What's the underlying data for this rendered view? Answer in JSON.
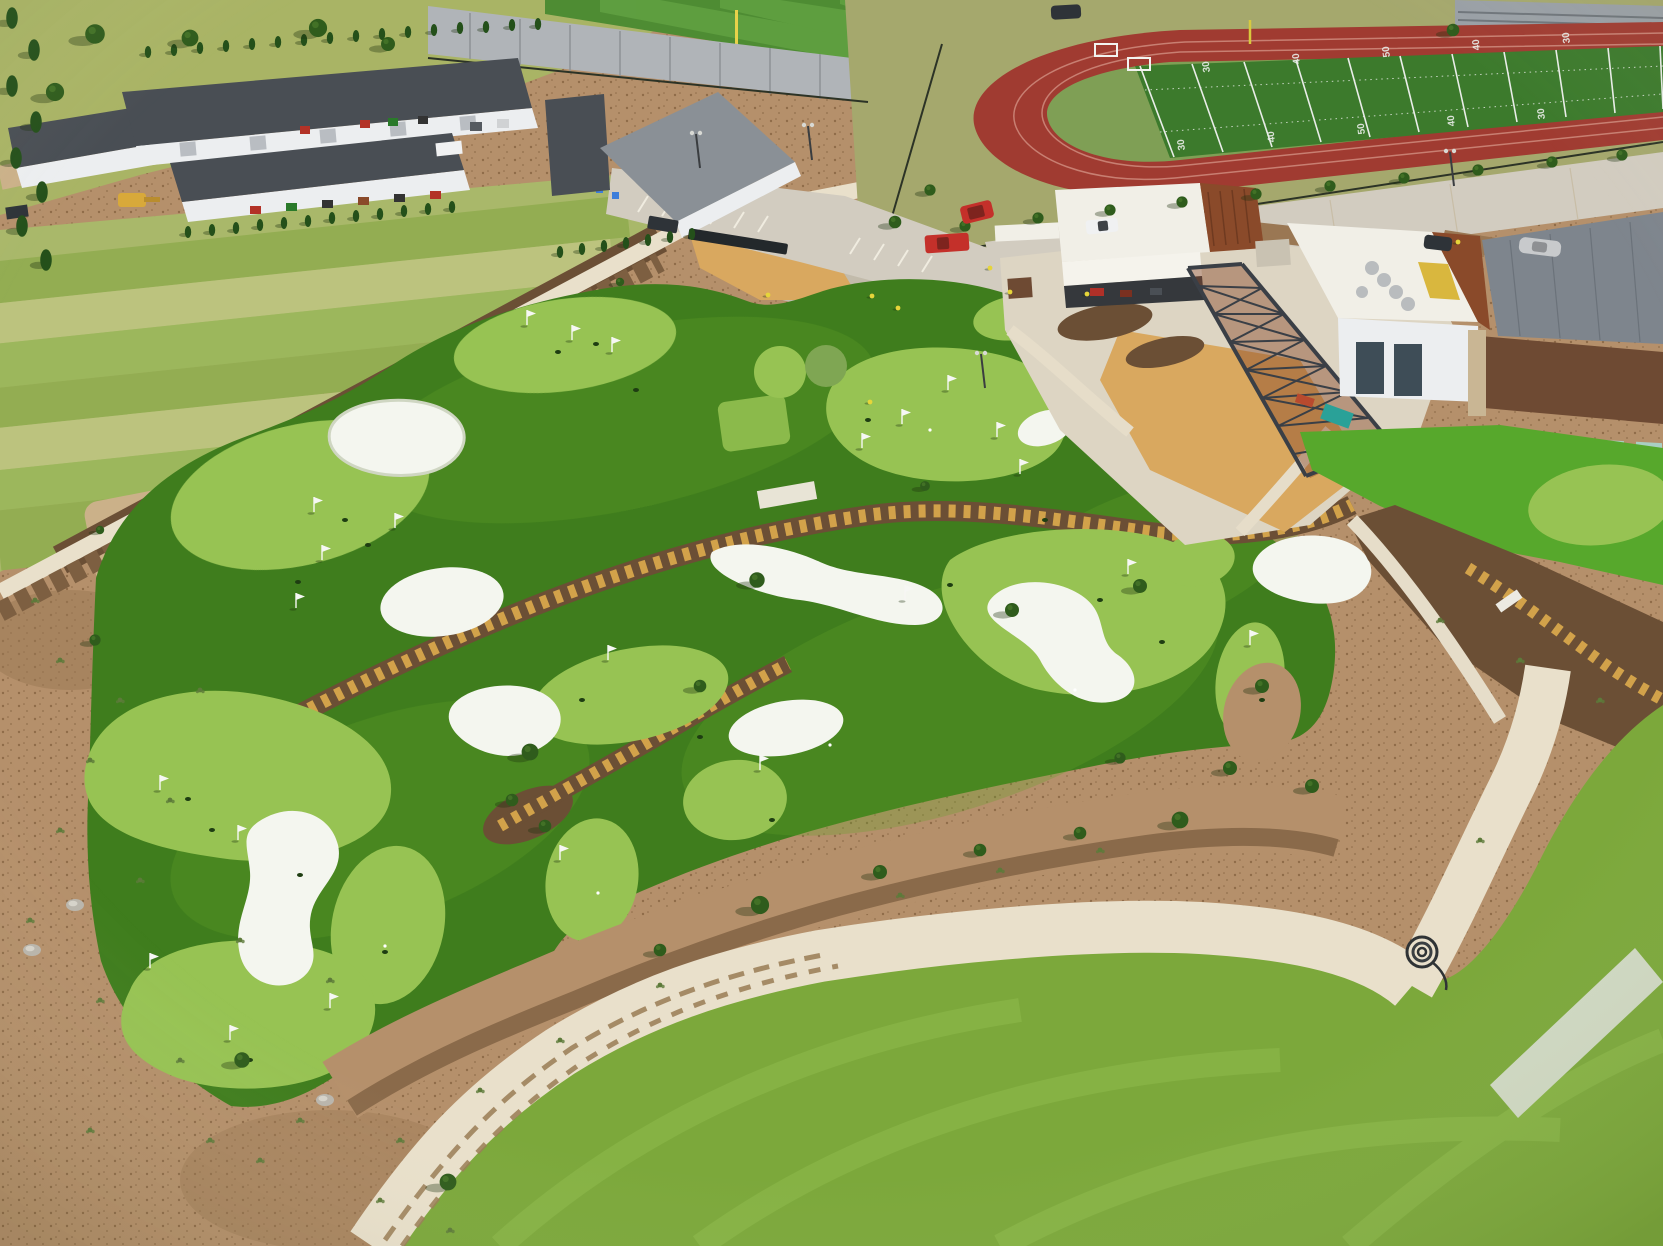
{
  "meta": {
    "description": "Aerial drone photograph of a newly built golf entertainment campus: a large artificial-turf putting course with white sand bunkers and flags, clubhouse with corten steel observation tower, maintenance warehouses, sod farm, baseball field, running track with football field, parking lots and walking paths.",
    "time_of_day": "midday, sunny",
    "view": "oblique aerial"
  },
  "palette": {
    "dirt": "#b5906b",
    "dirt_speckle": "#8f6c49",
    "dirt_dark": "#9a7753",
    "mulch": "#6b4f35",
    "rubble": "#7d5f41",
    "gravel_border": "#8a6a4a",
    "course_turf": "#3f7d1d",
    "course_turf_light": "#55941f",
    "course_streak": "#62a228",
    "putting_green": "#97c353",
    "putting_green_light": "#a8d163",
    "putting_olive": "#7fa653",
    "bunker": "#f4f6ef",
    "bunker_shadow": "#cfd6c2",
    "lawn": "#7ca83b",
    "lawn_streak": "#90bc4e",
    "path": "#e9e0cb",
    "path_joint": "#c8bda6",
    "path_dirt": "#9a7d55",
    "road": "#d2ccc0",
    "plaza": "#ddd5c3",
    "sidewalk": "#e6ddc9",
    "sod_a": "#a9b86a",
    "sod_b": "#93ad52",
    "sod_c": "#bcc37e",
    "sod_d": "#9cb75c",
    "field_grass": "#a5a86d",
    "topleft_grass": "#a9b465",
    "sand": "#d9a85f",
    "sand_pit": "#cbb189",
    "gravel_yard": "#c2bbab",
    "roof_dark": "#494e54",
    "roof_gray": "#8a9096",
    "wall_white": "#eceef0",
    "door_gray": "#b9bdc2",
    "clubhouse_roof": "#f1efe7",
    "corten": "#8a4a2a",
    "steel": "#3a3f46",
    "awning": "#f5f3ec",
    "patio_shadow": "#35383c",
    "bldg2_roof": "#7e858d",
    "brown_band": "#6e4a33",
    "window_glass": "#a9cfc2",
    "glass_dark": "#3e4d57",
    "stone": "#c9b694",
    "turf_apron": "#57a82c",
    "track": "#a03b31",
    "track_line": "#c87f72",
    "field_turf": "#3c7a2c",
    "dzone": "#7f9f55",
    "field_line": "#e9ede8",
    "ball_grass_a": "#4e8c33",
    "ball_grass_b": "#60a041",
    "infield_dirt": "#c29a62",
    "wall_gray": "#b0b4b8",
    "bleacher": "#9aa0a6",
    "fence": "#2c3326",
    "tree": "#2f5c1c",
    "tree_light": "#4a7a2b",
    "cypress": "#24501a",
    "shrub": "#5d7a3a",
    "tuft_gold": "#d2a24a",
    "flag_white": "#f6f7f4",
    "hole": "#1e3d12",
    "car_red": "#c4302a",
    "car_silver": "#c8cacc",
    "car_dark": "#2e3338",
    "car_white": "#f0f1f2",
    "excavator": "#d8a93a",
    "tarp_teal": "#2aa198",
    "hvac": "#b9bcbe",
    "safety_stripe": "#d9b73e",
    "foul_pole": "#e8d24a",
    "pale_strip": "#cfd8c2",
    "shadow": "rgba(30,50,15,0.35)",
    "wall_block": "#e8e4d6"
  },
  "scene": {
    "regions": [
      {
        "label": "maintenance warehouses with equipment yard",
        "position": "top-left"
      },
      {
        "label": "sod farm with turf strips and sand pit",
        "position": "left"
      },
      {
        "label": "baseball field behind gray outfield wall",
        "position": "top-center"
      },
      {
        "label": "running track with football field and bleachers",
        "position": "top-right"
      },
      {
        "label": "parking lot with truck and trailer",
        "position": "top-center"
      },
      {
        "label": "clubhouse with awning and corten observation tower",
        "position": "center-right"
      },
      {
        "label": "modern building with rooftop HVAC and glass doors",
        "position": "right"
      },
      {
        "label": "artificial putting course with bunkers, flags and creek beds",
        "position": "center"
      },
      {
        "label": "bare dirt landscape with young shrubs",
        "position": "bottom-left"
      },
      {
        "label": "natural grass lawn with curved concrete path",
        "position": "bottom-right"
      }
    ],
    "counts": {
      "putting_greens": 15,
      "bunkers": 9,
      "flags": 24,
      "vehicles": 10,
      "creek_beds": 3
    },
    "vehicles": [
      {
        "name": "red-suv",
        "color_key": "car_red"
      },
      {
        "name": "red-pickup",
        "color_key": "car_red"
      },
      {
        "name": "silver-car",
        "color_key": "car_silver"
      },
      {
        "name": "dark-car",
        "color_key": "car_dark"
      },
      {
        "name": "white-truck",
        "color_key": "car_white"
      },
      {
        "name": "pickup-with-trailer",
        "color_key": "car_dark"
      },
      {
        "name": "white-van",
        "color_key": "car_white"
      },
      {
        "name": "excavator",
        "color_key": "excavator"
      },
      {
        "name": "utility-cart",
        "color_key": "car_dark"
      },
      {
        "name": "dark-car-top",
        "color_key": "car_dark"
      }
    ],
    "football_field": {
      "surface": "green turf with white yard lines",
      "yard_numbers_far": [
        "30",
        "40",
        "50",
        "40",
        "30"
      ],
      "yard_numbers_near": [
        "30",
        "40",
        "50",
        "40",
        "30"
      ]
    }
  },
  "repeats": {
    "flags": [
      {
        "x": 527,
        "y": 325
      },
      {
        "x": 572,
        "y": 340
      },
      {
        "x": 612,
        "y": 352
      },
      {
        "x": 862,
        "y": 448
      },
      {
        "x": 902,
        "y": 424
      },
      {
        "x": 948,
        "y": 390
      },
      {
        "x": 997,
        "y": 437
      },
      {
        "x": 1020,
        "y": 474
      },
      {
        "x": 314,
        "y": 512
      },
      {
        "x": 395,
        "y": 528
      },
      {
        "x": 322,
        "y": 560
      },
      {
        "x": 296,
        "y": 608
      },
      {
        "x": 160,
        "y": 790
      },
      {
        "x": 238,
        "y": 840
      },
      {
        "x": 150,
        "y": 968
      },
      {
        "x": 230,
        "y": 1040
      },
      {
        "x": 330,
        "y": 1008
      },
      {
        "x": 608,
        "y": 660
      },
      {
        "x": 560,
        "y": 860
      },
      {
        "x": 760,
        "y": 770
      },
      {
        "x": 1128,
        "y": 574
      },
      {
        "x": 1250,
        "y": 645
      },
      {
        "x": 905,
        "y": 600
      },
      {
        "x": 1650,
        "y": 470
      }
    ],
    "holes": [
      {
        "x": 558,
        "y": 352
      },
      {
        "x": 596,
        "y": 344
      },
      {
        "x": 636,
        "y": 390
      },
      {
        "x": 345,
        "y": 520
      },
      {
        "x": 368,
        "y": 545
      },
      {
        "x": 298,
        "y": 582
      },
      {
        "x": 212,
        "y": 830
      },
      {
        "x": 582,
        "y": 700
      },
      {
        "x": 772,
        "y": 820
      },
      {
        "x": 1100,
        "y": 600
      },
      {
        "x": 1162,
        "y": 642
      },
      {
        "x": 700,
        "y": 737
      },
      {
        "x": 950,
        "y": 585
      },
      {
        "x": 868,
        "y": 420
      },
      {
        "x": 1045,
        "y": 520
      },
      {
        "x": 250,
        "y": 1060
      },
      {
        "x": 1262,
        "y": 700
      },
      {
        "x": 300,
        "y": 875
      },
      {
        "x": 188,
        "y": 799
      },
      {
        "x": 385,
        "y": 952
      }
    ],
    "balls": [
      {
        "x": 1140,
        "y": 470
      },
      {
        "x": 598,
        "y": 893
      },
      {
        "x": 830,
        "y": 745
      },
      {
        "x": 1075,
        "y": 690
      },
      {
        "x": 930,
        "y": 430
      },
      {
        "x": 385,
        "y": 946
      }
    ],
    "trees": [
      {
        "x": 965,
        "y": 226,
        "s": 0.8
      },
      {
        "x": 1038,
        "y": 218,
        "s": 0.8
      },
      {
        "x": 1110,
        "y": 210,
        "s": 0.8
      },
      {
        "x": 1182,
        "y": 202,
        "s": 0.8
      },
      {
        "x": 1256,
        "y": 194,
        "s": 0.8
      },
      {
        "x": 1330,
        "y": 186,
        "s": 0.8
      },
      {
        "x": 1404,
        "y": 178,
        "s": 0.8
      },
      {
        "x": 1478,
        "y": 170,
        "s": 0.8
      },
      {
        "x": 1552,
        "y": 162,
        "s": 0.8
      },
      {
        "x": 1622,
        "y": 155,
        "s": 0.8
      },
      {
        "x": 757,
        "y": 580,
        "s": 1.1
      },
      {
        "x": 1012,
        "y": 610,
        "s": 1
      },
      {
        "x": 1140,
        "y": 586,
        "s": 1
      },
      {
        "x": 925,
        "y": 486,
        "s": 0.7
      },
      {
        "x": 700,
        "y": 686,
        "s": 0.9
      },
      {
        "x": 530,
        "y": 752,
        "s": 1.2
      },
      {
        "x": 512,
        "y": 800,
        "s": 0.9
      },
      {
        "x": 545,
        "y": 826,
        "s": 0.9
      },
      {
        "x": 660,
        "y": 950,
        "s": 0.9
      },
      {
        "x": 760,
        "y": 905,
        "s": 1.3
      },
      {
        "x": 880,
        "y": 872,
        "s": 1
      },
      {
        "x": 980,
        "y": 850,
        "s": 0.9
      },
      {
        "x": 1080,
        "y": 833,
        "s": 0.9
      },
      {
        "x": 1180,
        "y": 820,
        "s": 1.2
      },
      {
        "x": 1262,
        "y": 686,
        "s": 1
      },
      {
        "x": 242,
        "y": 1060,
        "s": 1.1
      },
      {
        "x": 448,
        "y": 1182,
        "s": 1.2
      },
      {
        "x": 95,
        "y": 640,
        "s": 0.8
      },
      {
        "x": 1230,
        "y": 768,
        "s": 1
      },
      {
        "x": 1312,
        "y": 786,
        "s": 1
      },
      {
        "x": 1120,
        "y": 758,
        "s": 0.8
      },
      {
        "x": 95,
        "y": 34,
        "s": 1.4
      },
      {
        "x": 190,
        "y": 38,
        "s": 1.2
      },
      {
        "x": 318,
        "y": 28,
        "s": 1.3
      },
      {
        "x": 388,
        "y": 44,
        "s": 1
      },
      {
        "x": 55,
        "y": 92,
        "s": 1.3
      },
      {
        "x": 895,
        "y": 222,
        "s": 0.9
      },
      {
        "x": 930,
        "y": 190,
        "s": 0.8
      },
      {
        "x": 1453,
        "y": 30,
        "s": 0.9
      }
    ],
    "cypresses": [
      {
        "x": 148,
        "y": 52
      },
      {
        "x": 174,
        "y": 50
      },
      {
        "x": 200,
        "y": 48
      },
      {
        "x": 226,
        "y": 46
      },
      {
        "x": 252,
        "y": 44
      },
      {
        "x": 278,
        "y": 42
      },
      {
        "x": 304,
        "y": 40
      },
      {
        "x": 330,
        "y": 38
      },
      {
        "x": 356,
        "y": 36
      },
      {
        "x": 382,
        "y": 34
      },
      {
        "x": 408,
        "y": 32
      },
      {
        "x": 434,
        "y": 30
      },
      {
        "x": 460,
        "y": 28
      },
      {
        "x": 486,
        "y": 27
      },
      {
        "x": 512,
        "y": 25
      },
      {
        "x": 538,
        "y": 24
      },
      {
        "x": 188,
        "y": 232
      },
      {
        "x": 212,
        "y": 230
      },
      {
        "x": 236,
        "y": 228
      },
      {
        "x": 260,
        "y": 225
      },
      {
        "x": 284,
        "y": 223
      },
      {
        "x": 308,
        "y": 221
      },
      {
        "x": 332,
        "y": 218
      },
      {
        "x": 356,
        "y": 216
      },
      {
        "x": 380,
        "y": 214
      },
      {
        "x": 404,
        "y": 211
      },
      {
        "x": 428,
        "y": 209
      },
      {
        "x": 452,
        "y": 207
      },
      {
        "x": 560,
        "y": 252
      },
      {
        "x": 582,
        "y": 249
      },
      {
        "x": 604,
        "y": 246
      },
      {
        "x": 626,
        "y": 243
      },
      {
        "x": 648,
        "y": 240
      },
      {
        "x": 670,
        "y": 237
      },
      {
        "x": 692,
        "y": 234
      },
      {
        "x": 12,
        "y": 18,
        "s": 1.8
      },
      {
        "x": 34,
        "y": 50,
        "s": 1.8
      },
      {
        "x": 12,
        "y": 86,
        "s": 1.8
      },
      {
        "x": 36,
        "y": 122,
        "s": 1.8
      },
      {
        "x": 16,
        "y": 158,
        "s": 1.8
      },
      {
        "x": 42,
        "y": 192,
        "s": 1.8
      },
      {
        "x": 22,
        "y": 226,
        "s": 1.8
      },
      {
        "x": 46,
        "y": 260,
        "s": 1.8
      }
    ],
    "mulch_trees": [
      {
        "x": 100,
        "y": 530,
        "s": 0.6
      },
      {
        "x": 175,
        "y": 492,
        "s": 0.6
      },
      {
        "x": 250,
        "y": 452,
        "s": 0.6
      },
      {
        "x": 325,
        "y": 415,
        "s": 0.6
      },
      {
        "x": 400,
        "y": 380,
        "s": 0.6
      },
      {
        "x": 475,
        "y": 345,
        "s": 0.6
      },
      {
        "x": 550,
        "y": 312,
        "s": 0.6
      },
      {
        "x": 620,
        "y": 282,
        "s": 0.6
      }
    ],
    "shrubs": [
      {
        "x": 60,
        "y": 660
      },
      {
        "x": 120,
        "y": 700
      },
      {
        "x": 200,
        "y": 690
      },
      {
        "x": 90,
        "y": 760
      },
      {
        "x": 170,
        "y": 800
      },
      {
        "x": 60,
        "y": 830
      },
      {
        "x": 140,
        "y": 880
      },
      {
        "x": 240,
        "y": 940
      },
      {
        "x": 100,
        "y": 1000
      },
      {
        "x": 180,
        "y": 1060
      },
      {
        "x": 300,
        "y": 1120
      },
      {
        "x": 90,
        "y": 1130
      },
      {
        "x": 380,
        "y": 1200
      },
      {
        "x": 35,
        "y": 600
      },
      {
        "x": 260,
        "y": 1160
      },
      {
        "x": 450,
        "y": 1230
      },
      {
        "x": 30,
        "y": 920
      },
      {
        "x": 210,
        "y": 1140
      },
      {
        "x": 400,
        "y": 1140
      },
      {
        "x": 330,
        "y": 980
      },
      {
        "x": 480,
        "y": 1090
      },
      {
        "x": 560,
        "y": 1040
      },
      {
        "x": 660,
        "y": 985
      },
      {
        "x": 900,
        "y": 895
      },
      {
        "x": 1000,
        "y": 870
      },
      {
        "x": 1100,
        "y": 850
      },
      {
        "x": 1440,
        "y": 620
      },
      {
        "x": 1520,
        "y": 660
      },
      {
        "x": 1600,
        "y": 700
      },
      {
        "x": 1480,
        "y": 840
      }
    ],
    "people": [
      {
        "x": 990,
        "y": 268
      },
      {
        "x": 1087,
        "y": 294
      },
      {
        "x": 872,
        "y": 296
      },
      {
        "x": 898,
        "y": 308
      },
      {
        "x": 870,
        "y": 402
      },
      {
        "x": 1458,
        "y": 242
      },
      {
        "x": 768,
        "y": 295
      },
      {
        "x": 1010,
        "y": 292
      }
    ],
    "poles": [
      {
        "x": 700,
        "y": 168
      },
      {
        "x": 812,
        "y": 160
      },
      {
        "x": 985,
        "y": 388
      },
      {
        "x": 1454,
        "y": 186
      }
    ],
    "rocks": [
      {
        "x": 32,
        "y": 950
      },
      {
        "x": 75,
        "y": 905
      },
      {
        "x": 325,
        "y": 1100
      }
    ],
    "yard_numbers_far": [
      {
        "x": 1210,
        "y": 72,
        "r": -97,
        "label": "30"
      },
      {
        "x": 1300,
        "y": 64,
        "r": -97,
        "label": "40"
      },
      {
        "x": 1390,
        "y": 57,
        "r": -97,
        "label": "50"
      },
      {
        "x": 1480,
        "y": 50,
        "r": -97,
        "label": "40"
      },
      {
        "x": 1570,
        "y": 43,
        "r": -97,
        "label": "30"
      }
    ],
    "yard_numbers_near": [
      {
        "x": 1185,
        "y": 150,
        "r": -97,
        "label": "30"
      },
      {
        "x": 1275,
        "y": 142,
        "r": -97,
        "label": "40"
      },
      {
        "x": 1365,
        "y": 134,
        "r": -97,
        "label": "50"
      },
      {
        "x": 1455,
        "y": 126,
        "r": -97,
        "label": "40"
      },
      {
        "x": 1545,
        "y": 119,
        "r": -97,
        "label": "30"
      }
    ]
  }
}
